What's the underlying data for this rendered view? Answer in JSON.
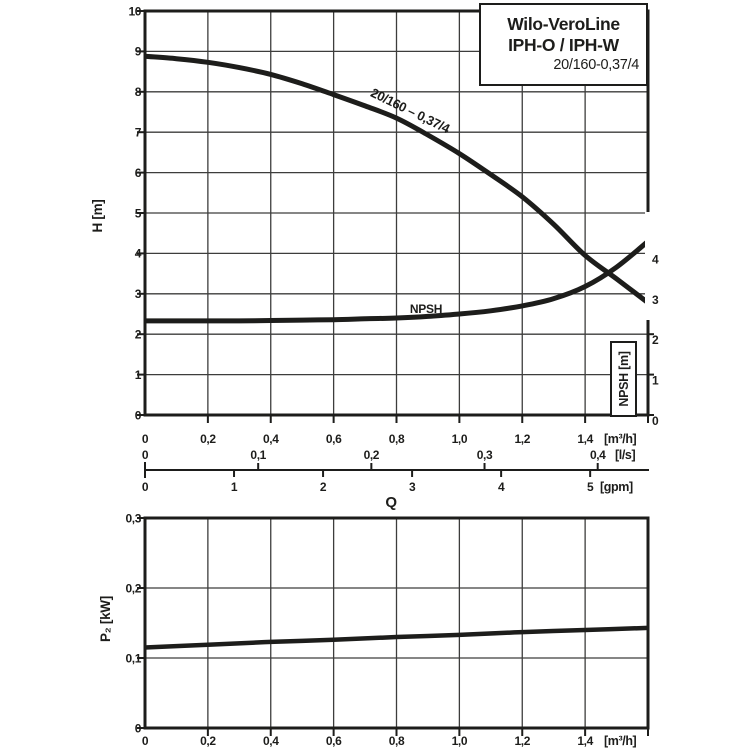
{
  "colors": {
    "background": "#ffffff",
    "ink": "#1d1d1b",
    "grid": "#3d3d3c"
  },
  "title_box": {
    "line1": "Wilo-VeroLine",
    "line2": "IPH-O / IPH-W",
    "line3": "20/160-0,37/4"
  },
  "labels": {
    "q": "Q",
    "h_axis": "H [m]",
    "p2_axis": "P₂ [kW]",
    "npsh_axis": "NPSH [m]",
    "npsh_curve": "NPSH",
    "h_curve": "20/160 – 0,37/4"
  },
  "chart_data": [
    {
      "type": "line",
      "title": "Pump head curve H/Q with NPSH curve",
      "xlabel": "Q",
      "ylabel": "H [m]",
      "xlim": [
        0,
        1.6
      ],
      "ylim": [
        0,
        10
      ],
      "grid": "on",
      "y_ticks": [
        0,
        1,
        2,
        3,
        4,
        5,
        6,
        7,
        8,
        9,
        10
      ],
      "x_scales": [
        {
          "unit": "[m³/h]",
          "tick_labels": [
            "0",
            "0,2",
            "0,4",
            "0,6",
            "0,8",
            "1,0",
            "1,2",
            "1,4"
          ],
          "tick_q": [
            0,
            0.2,
            0.4,
            0.6,
            0.8,
            1.0,
            1.2,
            1.4
          ]
        },
        {
          "unit": "[l/s]",
          "tick_labels": [
            "0",
            "0,1",
            "0,2",
            "0,3",
            "0,4"
          ],
          "tick_q": [
            0,
            0.36,
            0.72,
            1.08,
            1.44
          ]
        },
        {
          "unit": "[gpm]",
          "tick_labels": [
            "0",
            "1",
            "2",
            "3",
            "4",
            "5"
          ],
          "tick_q": [
            0,
            0.2832,
            0.5664,
            0.8496,
            1.1328,
            1.416
          ]
        }
      ],
      "right_axis": {
        "label": "NPSH [m]",
        "ticks": [
          0,
          1,
          2,
          3,
          4
        ]
      },
      "series": [
        {
          "name": "20/160 – 0,37/4",
          "x": [
            0,
            0.1,
            0.2,
            0.3,
            0.4,
            0.5,
            0.6,
            0.7,
            0.8,
            0.9,
            1.0,
            1.1,
            1.2,
            1.3,
            1.4,
            1.5,
            1.6
          ],
          "y": [
            8.88,
            8.82,
            8.73,
            8.6,
            8.43,
            8.2,
            7.93,
            7.65,
            7.35,
            6.93,
            6.47,
            5.95,
            5.4,
            4.72,
            3.95,
            3.37,
            2.78
          ]
        },
        {
          "name": "NPSH",
          "x": [
            0,
            0.1,
            0.2,
            0.3,
            0.4,
            0.5,
            0.6,
            0.7,
            0.8,
            0.9,
            1.0,
            1.1,
            1.2,
            1.3,
            1.4,
            1.5,
            1.6
          ],
          "y": [
            2.33,
            2.33,
            2.33,
            2.33,
            2.34,
            2.35,
            2.36,
            2.38,
            2.4,
            2.44,
            2.5,
            2.58,
            2.7,
            2.88,
            3.18,
            3.66,
            4.3
          ]
        }
      ]
    },
    {
      "type": "line",
      "title": "Shaft power curve",
      "xlabel": "Q",
      "ylabel": "P₂ [kW]",
      "xlim": [
        0,
        1.6
      ],
      "ylim": [
        0,
        0.3
      ],
      "grid": "on",
      "y_ticks": {
        "labels": [
          "0",
          "0,1",
          "0,2",
          "0,3"
        ],
        "values": [
          0,
          0.1,
          0.2,
          0.3
        ]
      },
      "x_scale": {
        "unit": "[m³/h]",
        "tick_labels": [
          "0",
          "0,2",
          "0,4",
          "0,6",
          "0,8",
          "1,0",
          "1,2",
          "1,4"
        ],
        "tick_q": [
          0,
          0.2,
          0.4,
          0.6,
          0.8,
          1.0,
          1.2,
          1.4
        ]
      },
      "series": [
        {
          "name": "P2",
          "x": [
            0,
            0.2,
            0.4,
            0.6,
            0.8,
            1.0,
            1.2,
            1.4,
            1.6
          ],
          "y": [
            0.115,
            0.119,
            0.123,
            0.126,
            0.13,
            0.133,
            0.137,
            0.14,
            0.143
          ]
        }
      ]
    }
  ]
}
